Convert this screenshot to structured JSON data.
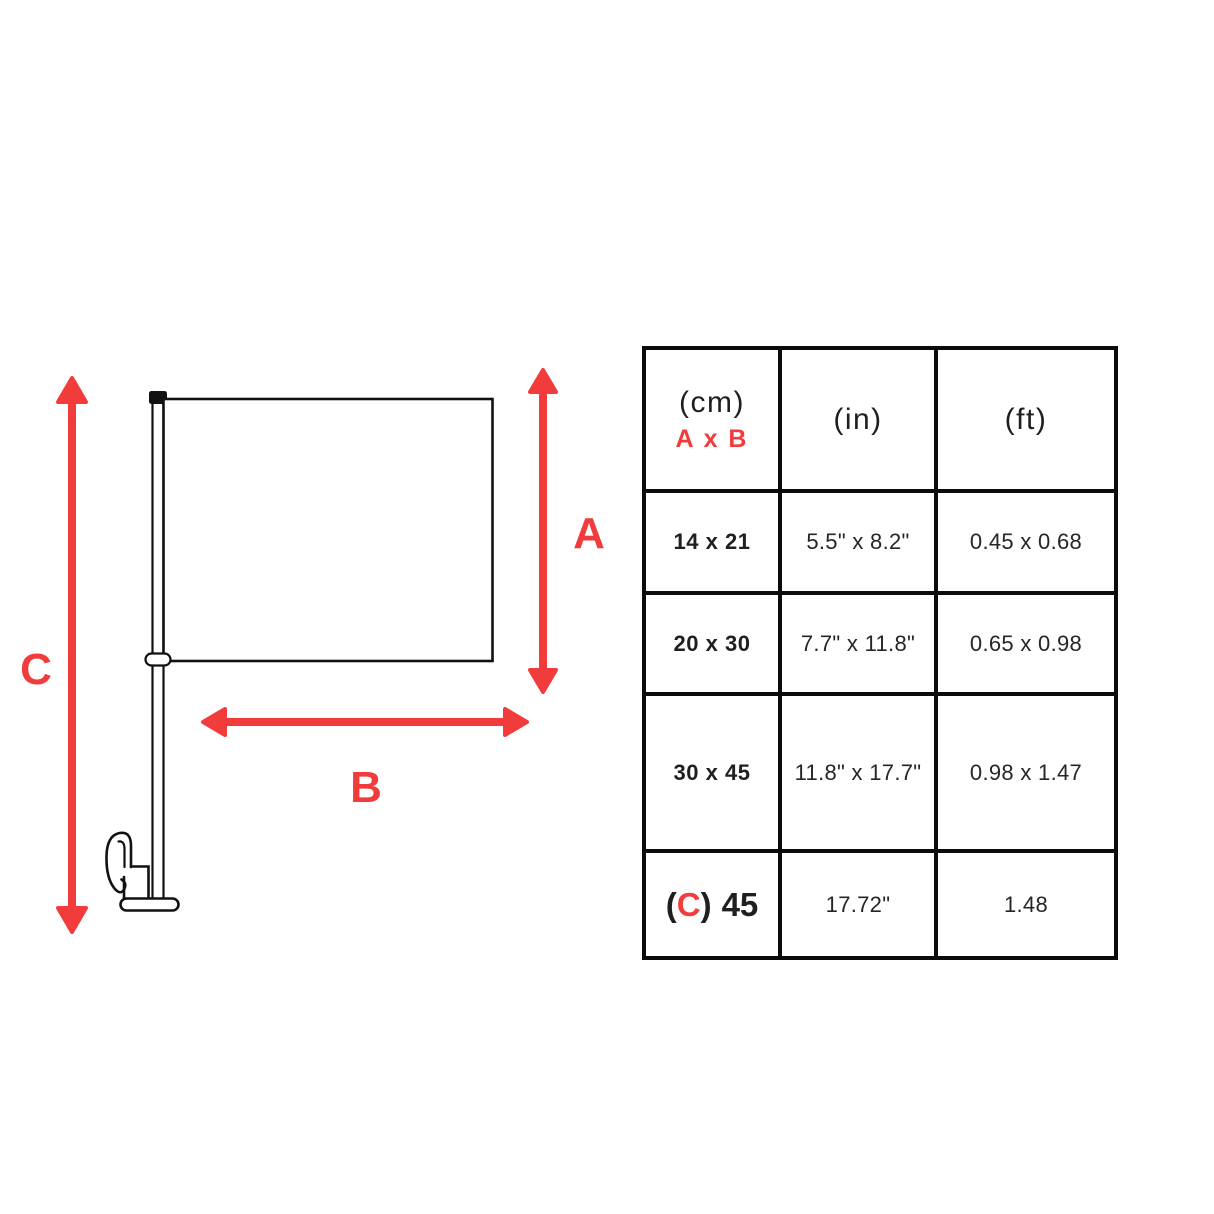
{
  "diagram": {
    "labels": {
      "a": "A",
      "b": "B",
      "c": "C"
    }
  },
  "table": {
    "header": {
      "cm_unit": "(cm)",
      "cm_sub": "A x B",
      "in_unit": "(in)",
      "ft_unit": "(ft)"
    },
    "rows": [
      {
        "cm": "14 x 21",
        "in": "5.5\" x 8.2\"",
        "ft": "0.45 x 0.68"
      },
      {
        "cm": "20 x 30",
        "in": "7.7\" x 11.8\"",
        "ft": "0.65 x 0.98"
      },
      {
        "cm": "30 x 45",
        "in": "11.8\" x 17.7\"",
        "ft": "0.98 x 1.47"
      },
      {
        "cm_open": "(",
        "cm_c": "C",
        "cm_close": ")",
        "cm_value": "45",
        "in": "17.72\"",
        "ft": "1.48"
      }
    ]
  },
  "colors": {
    "accent_red": "#F23C3C",
    "line_black": "#111111"
  }
}
